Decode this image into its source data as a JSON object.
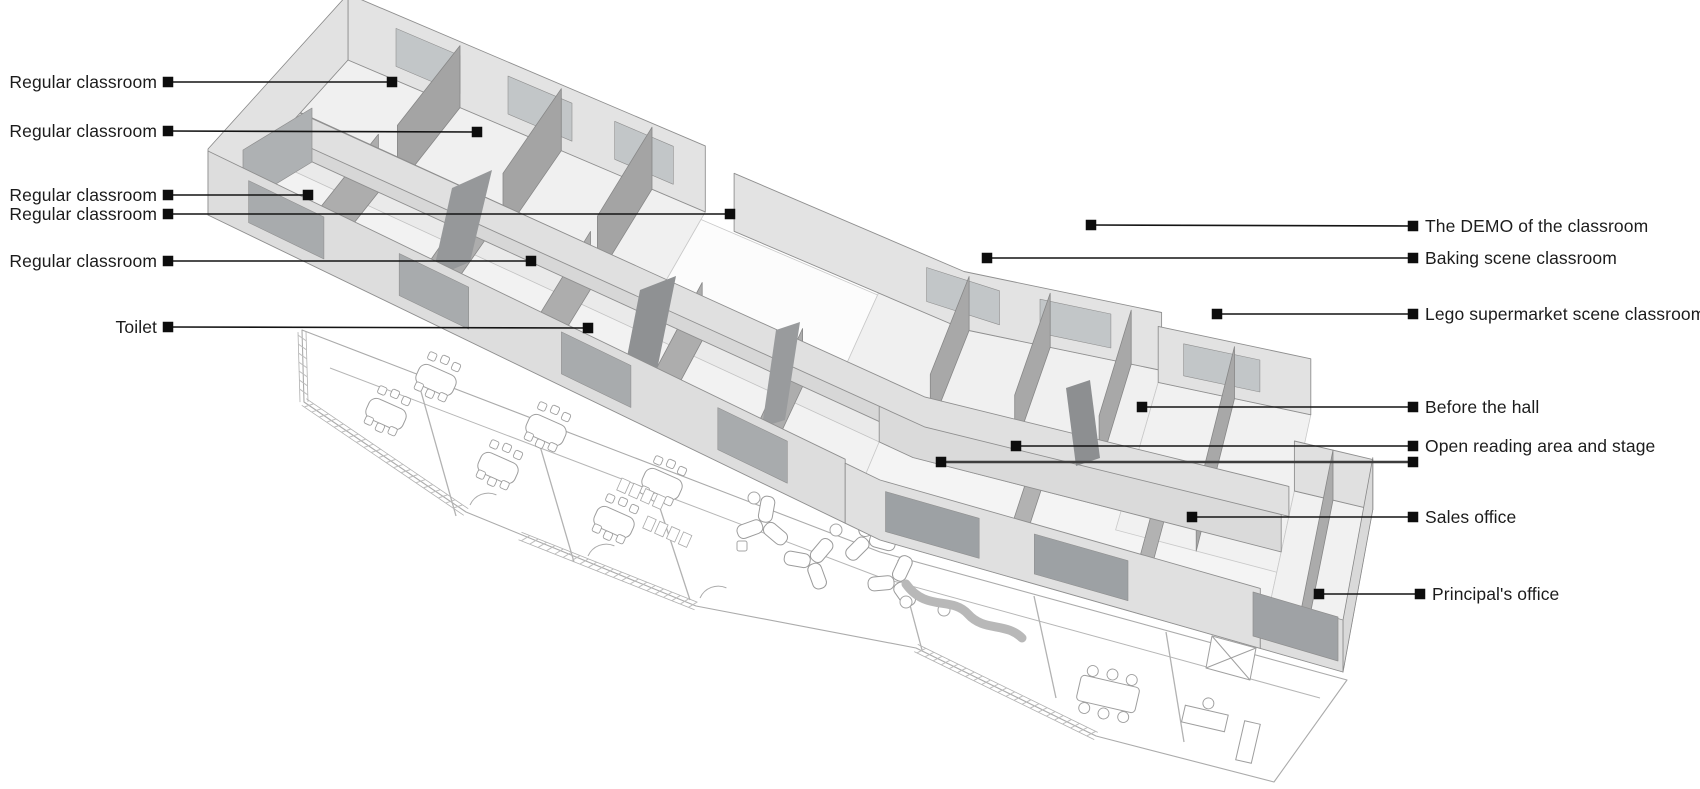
{
  "figure": {
    "type": "axonometric-floor-plan-diagram",
    "background": "#ffffff",
    "leader_color": "#141414",
    "marker_color": "#0d0d0d",
    "label_color": "#1c1c1c",
    "label_font_size": 17.5
  },
  "annotations_left": [
    {
      "label": "Regular classroom",
      "y": 82,
      "text_right_x": 157,
      "marker_x": 168,
      "target_x": 392,
      "target_y": 82
    },
    {
      "label": "Regular classroom",
      "y": 131,
      "text_right_x": 157,
      "marker_x": 168,
      "target_x": 477,
      "target_y": 132
    },
    {
      "label": "Regular classroom",
      "y": 195,
      "text_right_x": 157,
      "marker_x": 168,
      "target_x": 308,
      "target_y": 195
    },
    {
      "label": "Regular classroom",
      "y": 214,
      "text_right_x": 157,
      "marker_x": 168,
      "target_x": 730,
      "target_y": 214
    },
    {
      "label": "Regular classroom",
      "y": 261,
      "text_right_x": 157,
      "marker_x": 168,
      "target_x": 531,
      "target_y": 261
    },
    {
      "label": "Toilet",
      "y": 327,
      "text_right_x": 157,
      "marker_x": 168,
      "target_x": 588,
      "target_y": 328
    }
  ],
  "annotations_right": [
    {
      "label": "The DEMO of the classroom",
      "y": 226,
      "marker_x": 1413,
      "target_x": 1091,
      "target_y": 225
    },
    {
      "label": "Baking scene classroom",
      "y": 258,
      "marker_x": 1413,
      "target_x": 987,
      "target_y": 258
    },
    {
      "label": "Lego supermarket scene classroom",
      "y": 314,
      "marker_x": 1413,
      "target_x": 1217,
      "target_y": 314
    },
    {
      "label": "Before the hall",
      "y": 407,
      "marker_x": 1413,
      "target_x": 1142,
      "target_y": 407
    },
    {
      "label": "Open reading area and stage",
      "y": 446,
      "marker_x": 1413,
      "target_x": 1016,
      "target_y": 446
    },
    {
      "label": "",
      "y": 462,
      "marker_x": 1413,
      "target_x": 941,
      "target_y": 462,
      "thick": true
    },
    {
      "label": "Sales office",
      "y": 517,
      "marker_x": 1413,
      "target_x": 1192,
      "target_y": 517
    },
    {
      "label": "Principal's office",
      "y": 594,
      "marker_x": 1420,
      "target_x": 1319,
      "target_y": 594
    }
  ]
}
